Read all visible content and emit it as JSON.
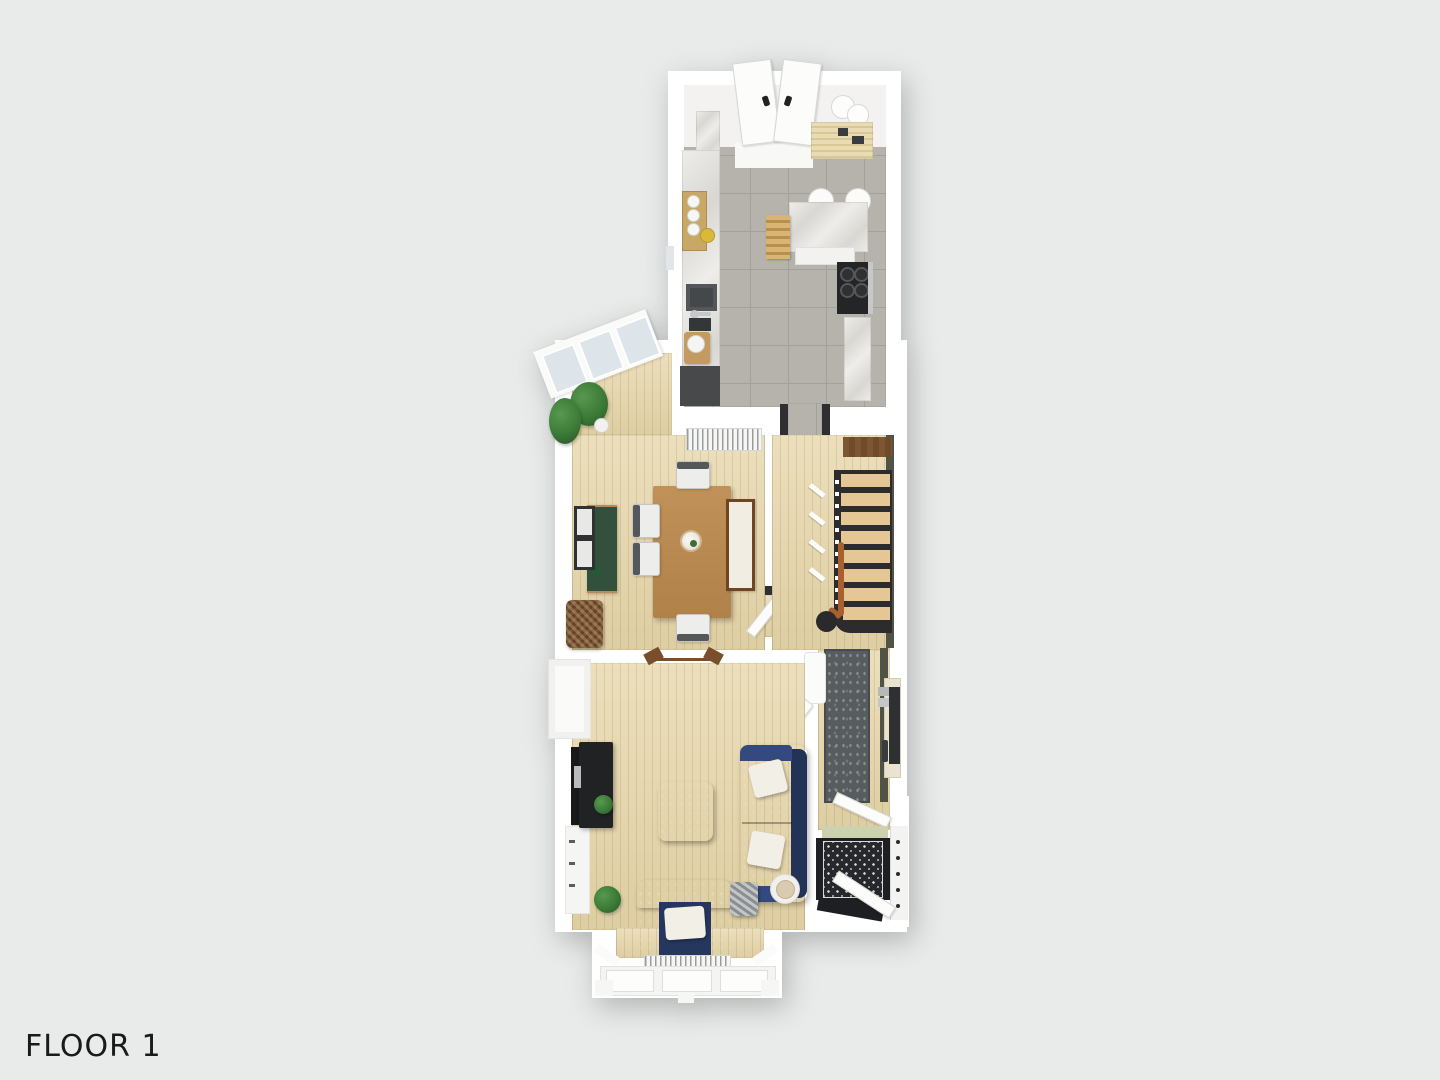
{
  "floor_label": "FLOOR 1",
  "palette": {
    "bg": "#e9ebeb",
    "wall": "#ffffff",
    "wall-shade": "#e3e4e4",
    "wood": "#e7d6a9",
    "wood-line": "#c9b386",
    "tile": "#b6b3ac",
    "tile-grout": "#a4a19a",
    "marble-a": "#efedea",
    "marble-b": "#d9d7d2",
    "navy": "#2b3f6d",
    "navy-dark": "#223357",
    "navy-seat": "#26375f",
    "pillow": "#f2efe7",
    "table-wood": "#ba8c54",
    "bench-wood": "#6f4526",
    "cushion": "#f1ede3",
    "green-cabinet": "#33503d",
    "plant": "#3c7a38",
    "plant-dark": "#2d5c2a",
    "stair-tread": "#e4c795",
    "dark": "#2c2c2e",
    "landing-wood": "#6f4b2c",
    "green-wall": "#4f5446",
    "rug": "#575c5e",
    "rug-edge": "#474b4d",
    "sienna": "#a9602f",
    "cream": "#e9e3cf",
    "mirror": "#2e3032",
    "entry-dark": "#1d1f22",
    "entry-dot": "#d8dadb",
    "threshold": "#ccd2ae",
    "door-white": "#fcfcfa",
    "frame-gray": "#d6d6d4",
    "slat": "#9a9c9e",
    "chrome": "#c6c8c9",
    "wicker": "#7a5331",
    "wicker-light": "#916540",
    "tv-dark": "#17191b",
    "chair-gray": "#54585a",
    "glass": "#dde5ea",
    "label-color": "#1a1a1a"
  },
  "rooms": [
    {
      "id": "kitchen",
      "furniture": [
        "back-double-door",
        "ceiling-light",
        "slat-bench",
        "marble-cabinet",
        "canister-shelf",
        "fruit-bowl",
        "sink",
        "wood-stool",
        "dishwasher-counter",
        "island",
        "bar-stools",
        "range-cooker",
        "side-counter"
      ]
    },
    {
      "id": "dining-room",
      "furniture": [
        "bay-window",
        "potted-plant",
        "potted-plant",
        "radiator",
        "dining-table",
        "flower-centerpiece",
        "dining-chair",
        "dining-chair",
        "dining-chair",
        "dining-chair",
        "bench",
        "green-sideboard",
        "picture-frames",
        "wicker-basket"
      ]
    },
    {
      "id": "hallway",
      "furniture": [
        "runner-rug",
        "console-table",
        "wall-mirror",
        "corner-bench",
        "hall-door",
        "vestibule-door"
      ]
    },
    {
      "id": "staircase",
      "furniture": [
        "stair-treads",
        "landing",
        "handrail",
        "newel-post",
        "balusters",
        "green-wall"
      ]
    },
    {
      "id": "living-room",
      "furniture": [
        "tv",
        "media-console",
        "plant-on-console",
        "ottoman",
        "sofa",
        "sofa-pillow",
        "sofa-pillow",
        "armchair",
        "armchair-pillow",
        "floor-plant",
        "storage-basket",
        "side-table",
        "table-lamp",
        "radiator",
        "bay-window",
        "open-double-door"
      ]
    },
    {
      "id": "entry",
      "furniture": [
        "patterned-tile-floor",
        "front-door",
        "door-frame",
        "threshold-mat"
      ]
    }
  ]
}
